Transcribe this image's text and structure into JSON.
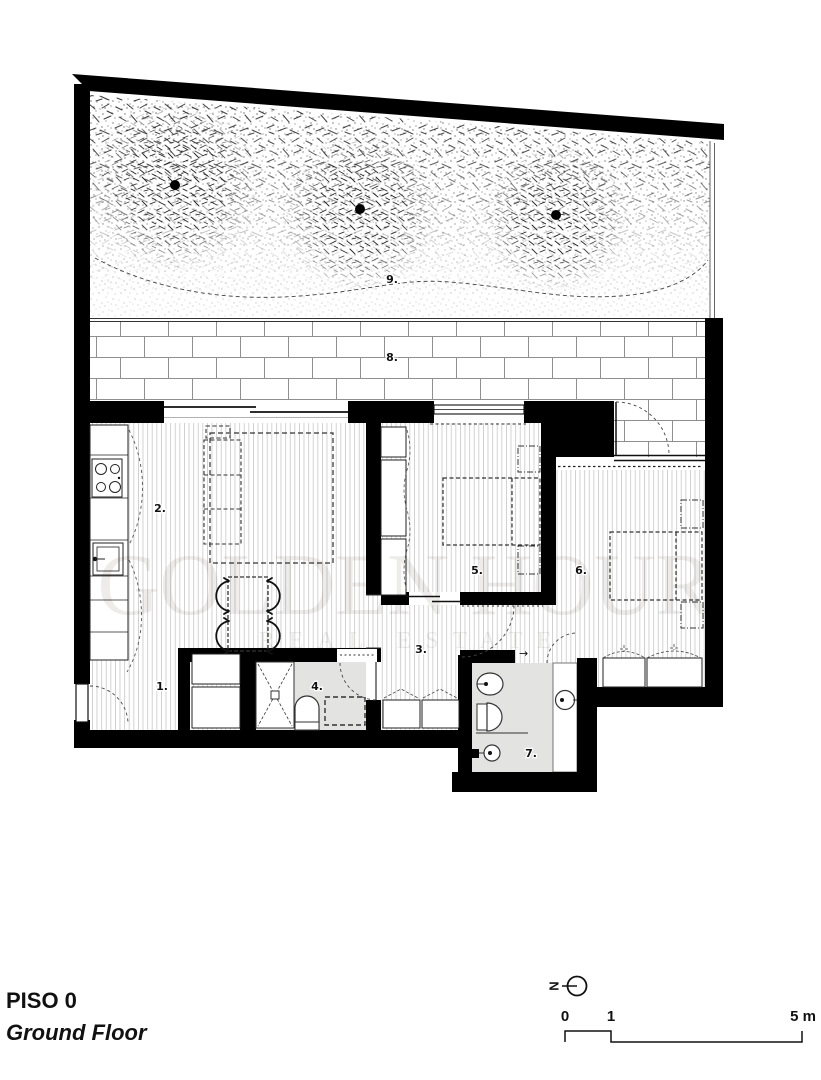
{
  "floor_plan": {
    "room_labels": [
      {
        "id": 1,
        "label": "1."
      },
      {
        "id": 2,
        "label": "2."
      },
      {
        "id": 3,
        "label": "3."
      },
      {
        "id": 4,
        "label": "4."
      },
      {
        "id": 5,
        "label": "5."
      },
      {
        "id": 6,
        "label": "6."
      },
      {
        "id": 7,
        "label": "7."
      },
      {
        "id": 8,
        "label": "8."
      },
      {
        "id": 9,
        "label": "9."
      }
    ],
    "watermark": {
      "line1": "GOLDEN HOUR",
      "line2": "REAL ESTATE"
    },
    "title_block": {
      "floor_code": "PISO 0",
      "floor_name": "Ground Floor"
    },
    "north_indicator": {
      "label": "N"
    },
    "scale_bar": {
      "tick_0": "0",
      "tick_1": "1",
      "tick_5": "5 m"
    },
    "symbols": {
      "entry_arrow": "→"
    },
    "colors": {
      "walls": "#000000",
      "bathroom_floor": "#e3e3e2",
      "watermark": "#dedcda",
      "linework": "#1a1a1a"
    }
  }
}
